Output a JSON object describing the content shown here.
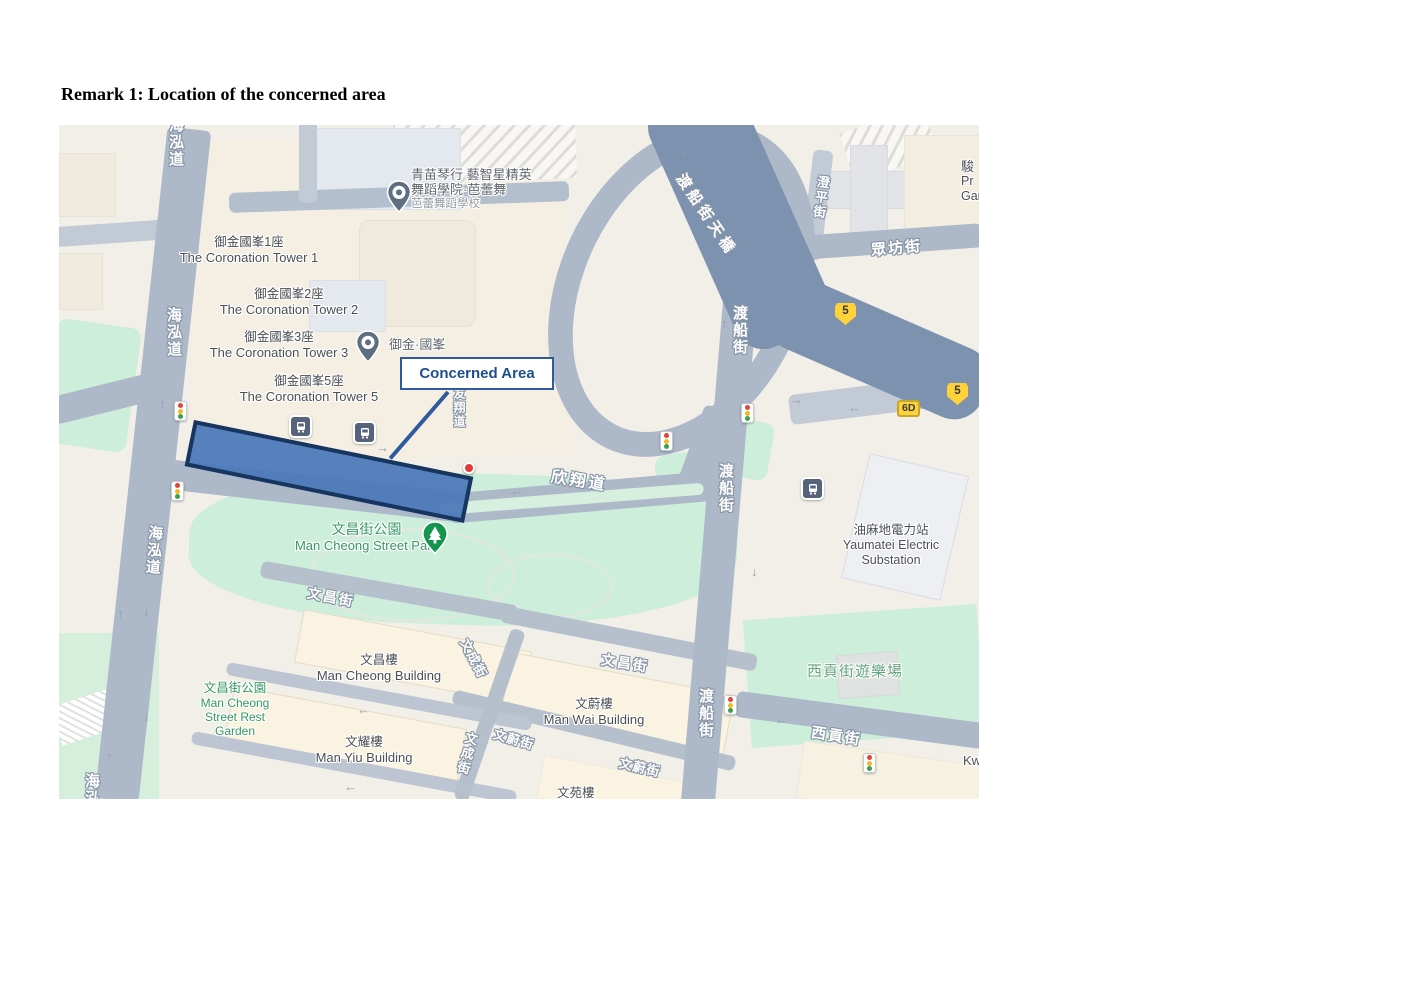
{
  "page": {
    "heading": "Remark 1: Location of the concerned area"
  },
  "map": {
    "callout_label": "Concerned Area",
    "places": {
      "coronation_tower_1": {
        "zh": "御金國峯1座",
        "en": "The Coronation Tower 1"
      },
      "coronation_tower_2": {
        "zh": "御金國峯2座",
        "en": "The Coronation Tower 2"
      },
      "coronation_tower_3": {
        "zh": "御金國峯3座",
        "en": "The Coronation Tower 3"
      },
      "coronation_tower_5": {
        "zh": "御金國峯5座",
        "en": "The Coronation Tower 5"
      },
      "coronation_poi": {
        "zh": "御金·國峯"
      },
      "music_school": {
        "line1": "青苗琴行 藝智星精英",
        "line2": "舞蹈學院·芭蕾舞",
        "line3": "芭蕾舞蹈學校"
      },
      "man_cheong_street_park": {
        "zh": "文昌街公園",
        "en": "Man Cheong Street Park"
      },
      "yaumatei_electric_substation": {
        "zh": "油麻地電力站",
        "en1": "Yaumatei Electric",
        "en2": "Substation"
      },
      "man_cheong_street_rest_garden": {
        "zh": "文昌街公園",
        "en1": "Man Cheong",
        "en2": "Street Rest",
        "en3": "Garden"
      },
      "man_cheong_building": {
        "zh": "文昌樓",
        "en": "Man Cheong Building"
      },
      "man_wai_building": {
        "zh": "文蔚樓",
        "en": "Man Wai Building"
      },
      "man_yiu_building": {
        "zh": "文耀樓",
        "en": "Man Yiu Building"
      },
      "man_yuen_building_partial": {
        "zh": "文苑樓"
      },
      "saigon_street_playground": {
        "zh": "西貢街遊樂場"
      },
      "prosperous_garden_clipped": {
        "l1": "駿",
        "l2": "Pr",
        "l3": "Gar"
      },
      "k_label_clipped": "Kw"
    },
    "streets": {
      "hoi_wang_road_top": "海泓道",
      "hoi_wang_road_upper": "海泓道",
      "hoi_wang_road_mid": "海泓道",
      "hoi_wang_road_bottom": "海泓道",
      "hin_cheung_road": "欣翔道",
      "yau_cheung_road": "友翔道",
      "ferry_street_flyover": "渡船街天橋",
      "ferry_street_1": "渡船街",
      "ferry_street_2": "渡船街",
      "ferry_street_3": "渡船街",
      "public_square_street": "眾坊街",
      "ching_ping_street": "澄平街",
      "man_cheong_street_1": "文昌街",
      "man_cheong_street_2": "文昌街",
      "man_wai_street_1": "文蔚街",
      "man_wai_street_2": "文蔚街",
      "man_shing_street_1": "文成街",
      "man_shing_street_2": "文成街",
      "saigon_street": "西貢街"
    },
    "badges": {
      "route_5a": "5",
      "route_5b": "5",
      "route_6d": "6D"
    },
    "colors": {
      "concerned_fill": "#4a79b9",
      "concerned_border": "#17355f",
      "callout_text": "#1e4e8f",
      "road": "#adb8c8",
      "flyover": "#7d92ae",
      "park": "#cdeedb",
      "badge_yellow": "#fdd23a"
    }
  }
}
